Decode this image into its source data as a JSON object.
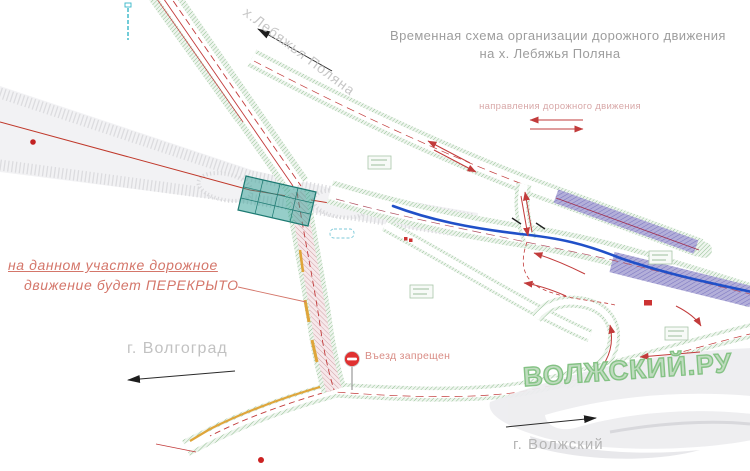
{
  "title": {
    "line1": "Временная схема организации дорожного движения",
    "line2": "на х. Лебяжья Поляна"
  },
  "legend": {
    "label": "направления дорожного движения",
    "arrow_left_direction": "left",
    "arrow_right_direction": "right"
  },
  "closure_note": {
    "line1": "на данном участке дорожное",
    "line2": "движение будет ПЕРЕКРЫТО"
  },
  "labels": {
    "volgograd": "г. Волгоград",
    "lebyazhya_polyana": "х.Лебяжья Поляна",
    "volzhsky": "г. Волжский"
  },
  "no_entry_sign": {
    "label": "Въезд запрещен"
  },
  "watermark": {
    "text": "ВОЛЖСКИЙ.РУ"
  },
  "colors": {
    "traffic_arrow_red": "#c23b3b",
    "closed_section_pink": "#f6e8ea",
    "roadside_green": "#86b886",
    "bridge_teal": "#2e9e94",
    "water_line_blue": "#2050c8",
    "restricted_zone_purple": "#7b76c2",
    "note_text": "#d4766a",
    "muted_label_gray": "#b5b5b5",
    "watermark_green": "#84c284",
    "curb_yellow": "#dfa53a"
  }
}
